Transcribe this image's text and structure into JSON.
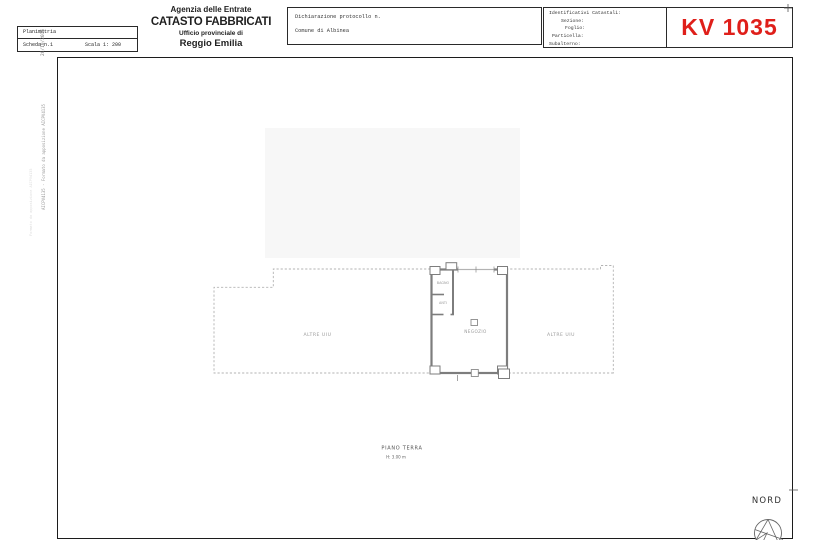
{
  "header": {
    "left_box": {
      "row1": "Planimetria",
      "row2_left": "Scheda n.1",
      "row2_right": "Scala 1: 200"
    },
    "agency_block": {
      "line1": "Agenzia delle Entrate",
      "line2": "CATASTO FABBRICATI",
      "line3": "Ufficio provinciale di",
      "line4": "Reggio Emilia"
    },
    "declaration_box": {
      "line1": "Dichiarazione protocollo n.",
      "line2": "Comune di Albinea"
    },
    "cadastral_box": {
      "title": "Identificativi Catastali:",
      "field1": "Sezione:",
      "field2": "Foglio:",
      "field3": "Particella:",
      "field4": "Subalterno:"
    },
    "doc_code": "KV 1035",
    "doc_code_color": "#df1f1a"
  },
  "margin": {
    "date_text": "26/10/2016",
    "signature_text": "AICPV4135 - Formato da apposizione AICPV4135",
    "signature_text_faint": "Formato da apposizione AICPV4135"
  },
  "plan": {
    "label_left_area": "ALTRE UIU",
    "label_right_area": "ALTRE UIU",
    "label_shop": "NEGOZIO",
    "label_bath": "BAGNO",
    "label_anteroom": "ANTI",
    "floor_title": "PIANO TERRA",
    "floor_height": "H: 3.00 m",
    "compass_label": "NORD"
  }
}
